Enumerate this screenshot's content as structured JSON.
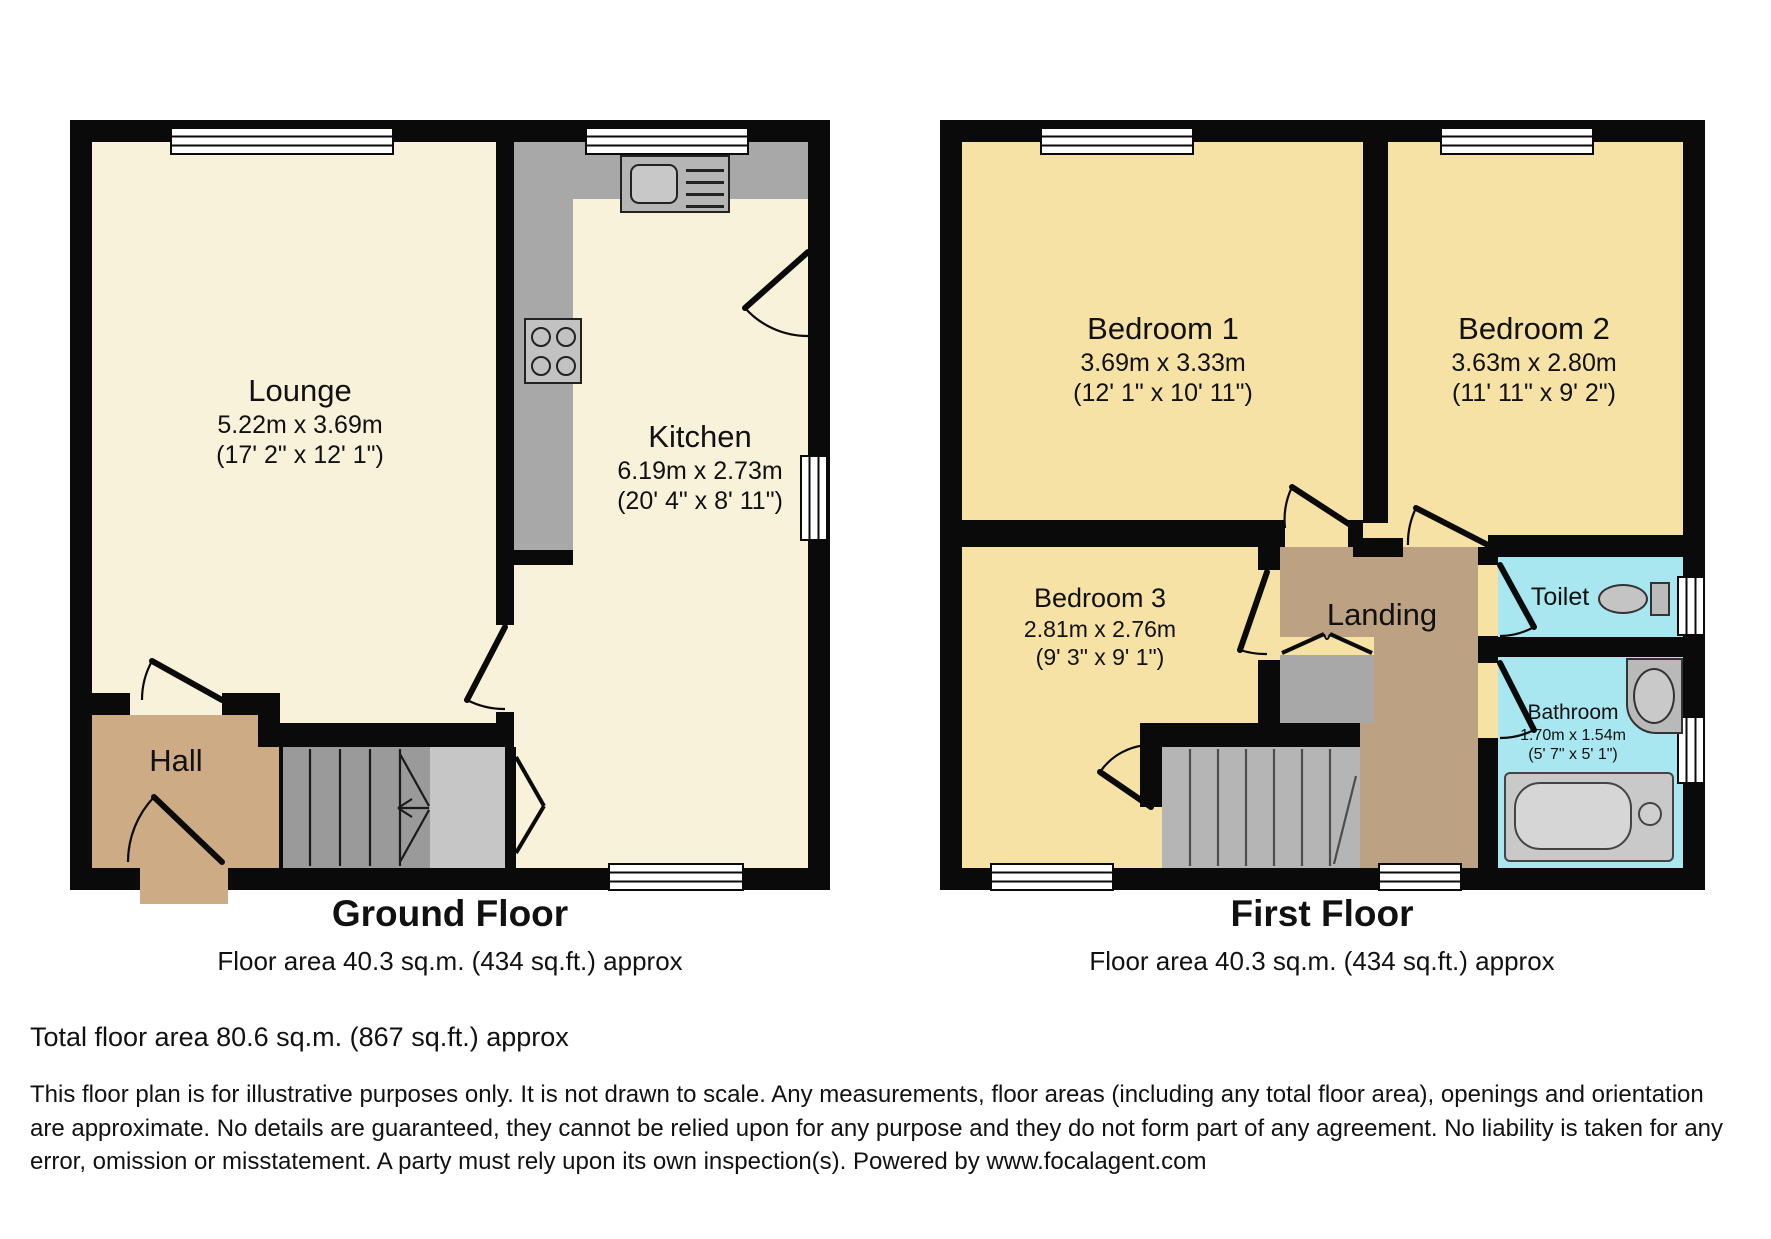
{
  "ground_floor": {
    "title": "Ground Floor",
    "area_caption": "Floor area 40.3 sq.m. (434 sq.ft.) approx",
    "rooms": {
      "lounge": {
        "name": "Lounge",
        "metric": "5.22m x 3.69m",
        "imperial": "(17' 2\" x 12' 1\")"
      },
      "kitchen": {
        "name": "Kitchen",
        "metric": "6.19m x 2.73m",
        "imperial": "(20' 4\" x 8' 11\")"
      },
      "hall": {
        "name": "Hall"
      }
    }
  },
  "first_floor": {
    "title": "First Floor",
    "area_caption": "Floor area 40.3 sq.m. (434 sq.ft.) approx",
    "rooms": {
      "bedroom1": {
        "name": "Bedroom 1",
        "metric": "3.69m x 3.33m",
        "imperial": "(12' 1\" x 10' 11\")"
      },
      "bedroom2": {
        "name": "Bedroom 2",
        "metric": "3.63m x 2.80m",
        "imperial": "(11' 11\" x 9' 2\")"
      },
      "bedroom3": {
        "name": "Bedroom 3",
        "metric": "2.81m x 2.76m",
        "imperial": "(9' 3\" x 9' 1\")"
      },
      "landing": {
        "name": "Landing"
      },
      "toilet": {
        "name": "Toilet"
      },
      "bathroom": {
        "name": "Bathroom",
        "metric": "1.70m x 1.54m",
        "imperial": "(5' 7\" x 5' 1\")"
      }
    }
  },
  "footer": {
    "total": "Total floor area 80.6 sq.m. (867 sq.ft.) approx",
    "disclaimer": "This floor plan is for illustrative purposes only. It is not drawn to scale. Any measurements, floor areas (including any total floor area), openings and orientation are approximate. No details are guaranteed, they cannot be relied upon for any purpose and they do not form part of any agreement. No liability is taken for any error, omission or misstatement. A party must rely upon its own inspection(s). Powered by www.focalagent.com"
  },
  "colors": {
    "wall": "#0a0a0a",
    "cream": "#f8f2da",
    "yellow": "#f6e2a4",
    "tan-hall": "#cdab84",
    "tan-landing": "#bda183",
    "cyan": "#a8e7f0",
    "stair": "#9a9a9a",
    "stair-light": "#b5b5b5",
    "counter": "#a8a8a8",
    "cupboard": "#c6c6c6",
    "fixture": "#c2c2c2"
  }
}
